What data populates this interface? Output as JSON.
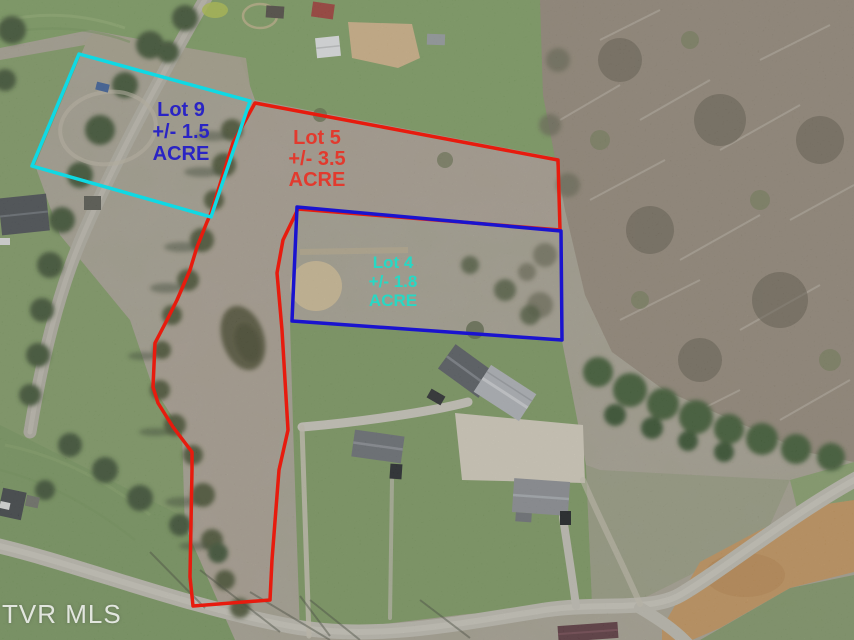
{
  "watermark": {
    "text": "TVR MLS"
  },
  "lots": [
    {
      "name": "Lot 9",
      "acreage": "+/- 1.5",
      "unit": "ACRE",
      "boundary_color": "#0fd9e4",
      "label_color": "#2a24c4"
    },
    {
      "name": "Lot 5",
      "acreage": "+/- 3.5",
      "unit": "ACRE",
      "boundary_color": "#e71b0e",
      "label_color": "#e23a2e"
    },
    {
      "name": "Lot 4",
      "acreage": "+/- 1.8",
      "unit": "ACRE",
      "boundary_color": "#1a13cf",
      "label_color": "#27d8c4"
    }
  ]
}
